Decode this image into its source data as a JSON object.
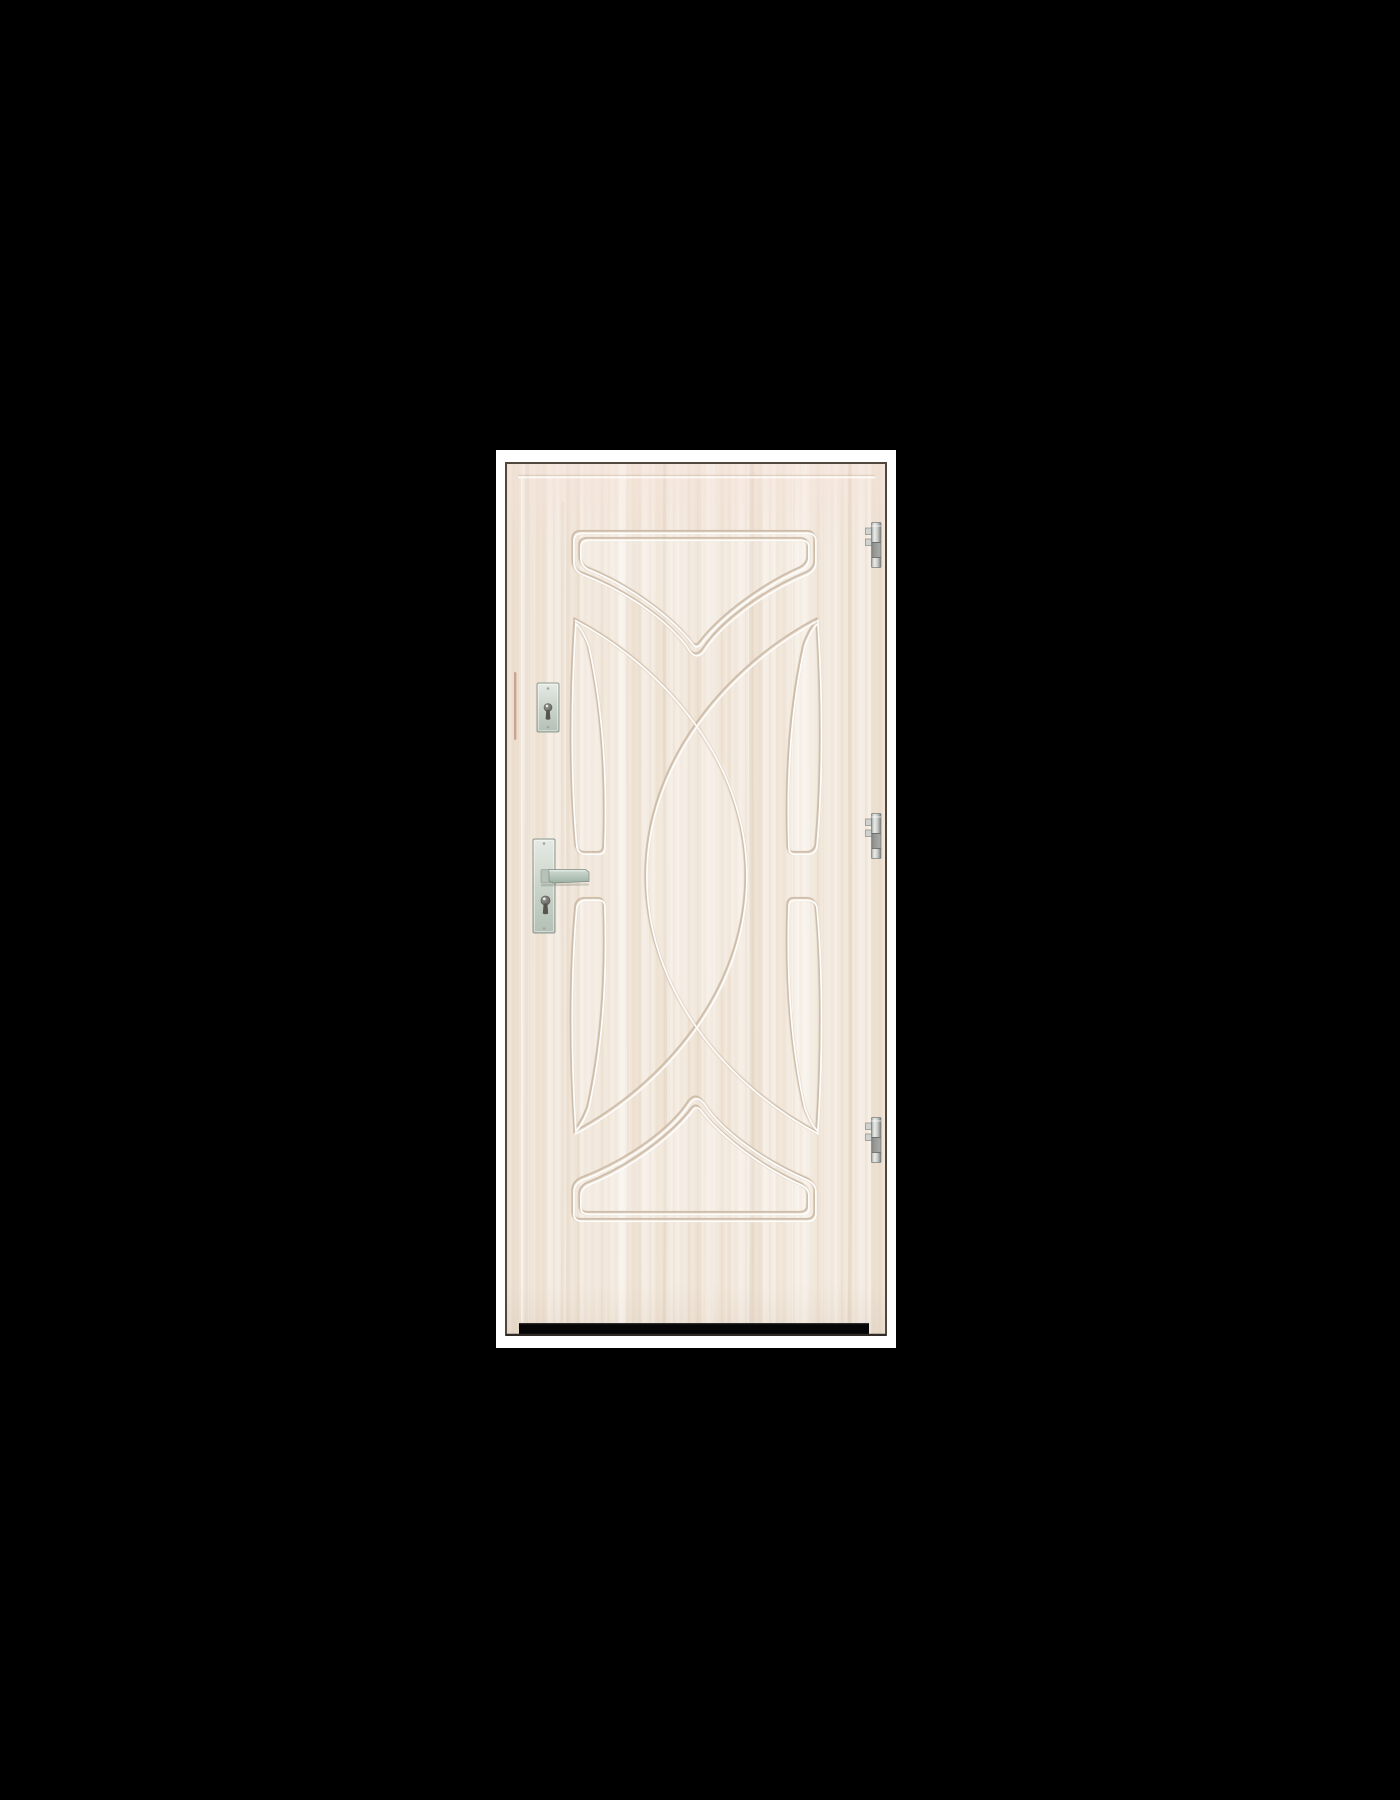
{
  "scene": {
    "background_color": "#000000",
    "photo": {
      "background_color": "#ffffff",
      "alt": "Product photo of a white-washed wood laminate steel entry door with embossed arc pattern"
    }
  },
  "door": {
    "alt": "Door leaf, right-hinged, cream white-washed oak finish",
    "face_color": "#f1e7dc",
    "groove_shadow_color": "#c7b5a1",
    "groove_highlight_color": "#ffffff",
    "outline_color": "#51473d",
    "threshold_color": "#060606",
    "edge_seal_color": "#c79c8b",
    "hardware_finish_color": "#c3cfc6",
    "pattern_description": "top and bottom chevron panels, four narrow side blade panels, two crossing arcs forming a central pointed oval",
    "hinges": {
      "label": "hinge",
      "count": 3
    },
    "deadbolt": {
      "label": "deadbolt cylinder escutcheon"
    },
    "handle": {
      "label": "lever handle with long backplate and cylinder"
    },
    "threshold": {
      "label": "threshold strip"
    }
  }
}
